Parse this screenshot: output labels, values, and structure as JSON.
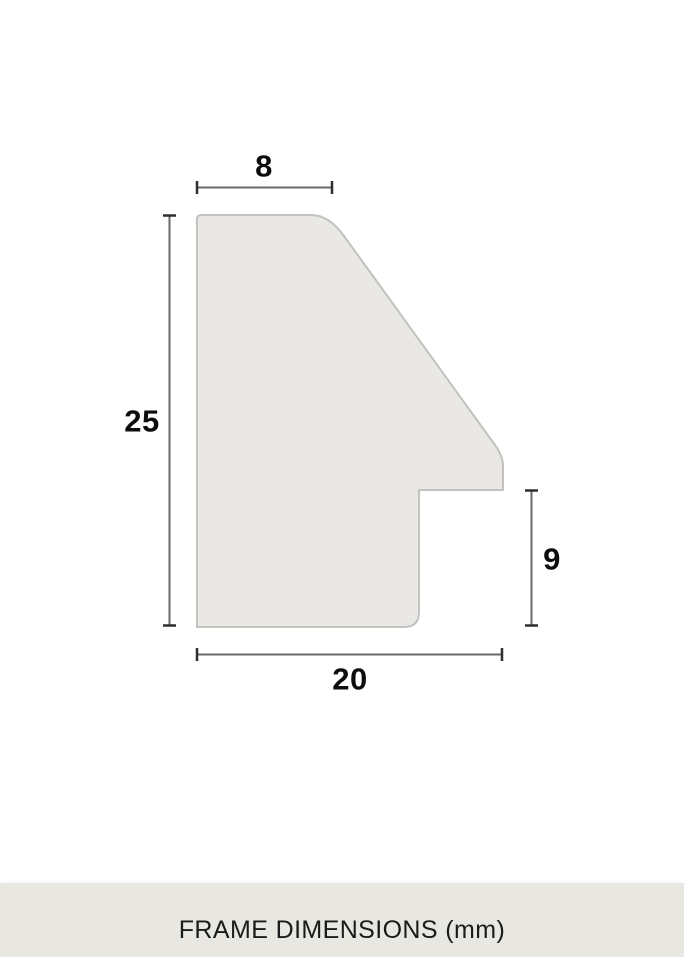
{
  "diagram": {
    "kind": "frame-profile-cross-section",
    "dimension_labels": {
      "top_width": "8",
      "left_height": "25",
      "right_rabbet_height": "9",
      "bottom_width": "20"
    },
    "measurements_mm": {
      "top_width": 8,
      "left_height": 25,
      "right_rabbet_height": 9,
      "bottom_width": 20
    }
  },
  "footer": {
    "caption": "FRAME DIMENSIONS (mm)"
  },
  "colors": {
    "background": "#ffffff",
    "profile_fill": "#e9e8e5",
    "profile_stroke": "#c3c2be",
    "dimension_line": "#6a6a6a",
    "dimension_tick": "#2f2f2f",
    "label_text": "#0d0d0d",
    "footer_background": "#e8e7e2",
    "footer_text": "#1b1b1b"
  }
}
